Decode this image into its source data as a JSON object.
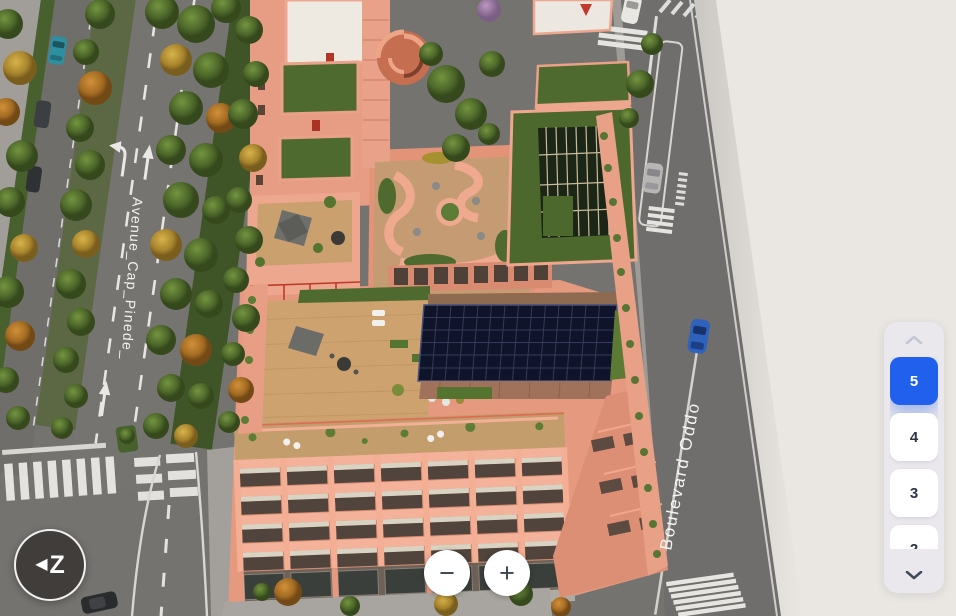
{
  "scene": {
    "street_labels": [
      {
        "text": "Avenue_Cap_Pinede_"
      },
      {
        "text": "Boulevard Oddo"
      }
    ]
  },
  "controls": {
    "compass": {
      "arrow": "◀",
      "letter": "Z"
    },
    "zoom": {
      "out": "−",
      "in": "+"
    },
    "floor_selector": {
      "floors": [
        {
          "label": "5",
          "selected": true
        },
        {
          "label": "4",
          "selected": false
        },
        {
          "label": "3",
          "selected": false
        },
        {
          "label": "2",
          "selected": false
        }
      ]
    }
  },
  "colors": {
    "accent_blue": "#2160ec",
    "panel_bg": "#eae8ec",
    "canvas_background": "#eae7e3",
    "building_salmon": "#efa58c",
    "roof_green": "#4e6a2e",
    "solar_navy": "#10142a",
    "road_gray": "#747370",
    "deck_wood": "#cda26f"
  }
}
